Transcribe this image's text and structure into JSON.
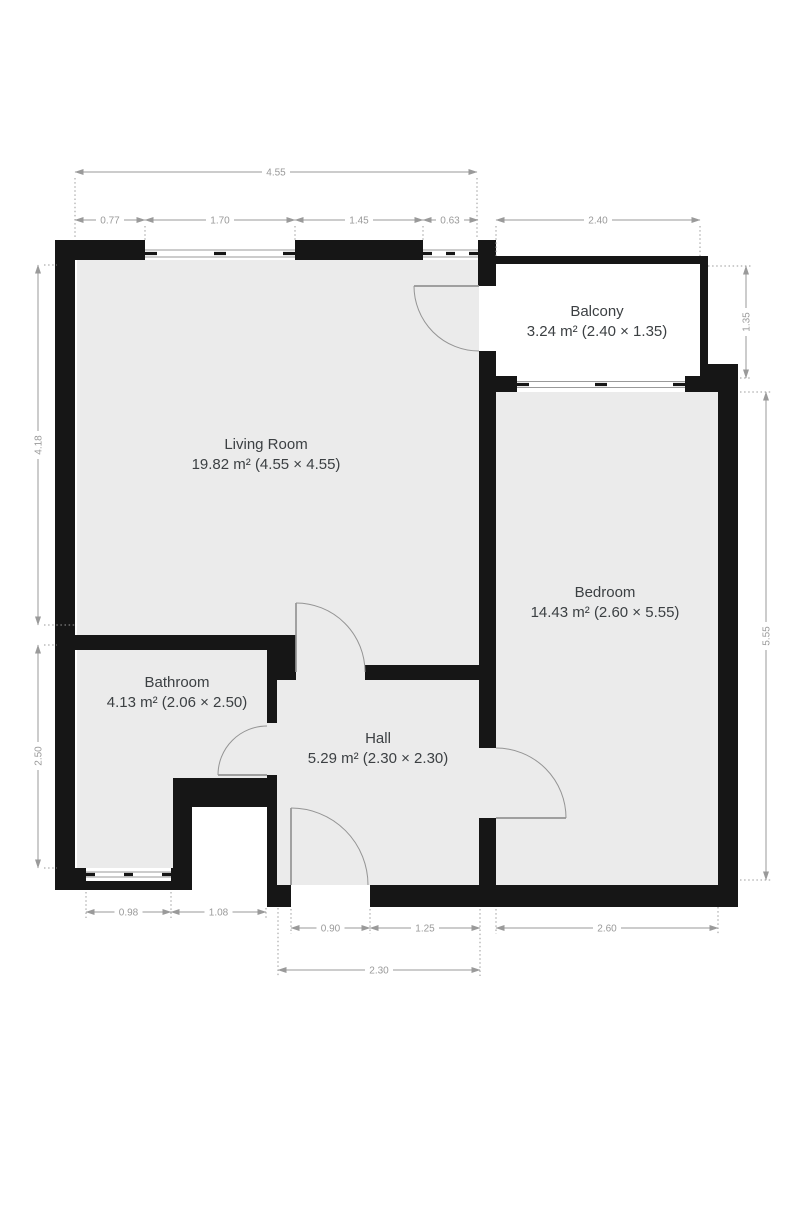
{
  "rooms": [
    {
      "name": "Living Room",
      "area": "19.82 m² (4.55 × 4.55)"
    },
    {
      "name": "Balcony",
      "area": "3.24 m² (2.40 × 1.35)"
    },
    {
      "name": "Bedroom",
      "area": "14.43 m² (2.60 × 5.55)"
    },
    {
      "name": "Bathroom",
      "area": "4.13 m² (2.06 × 2.50)"
    },
    {
      "name": "Hall",
      "area": "5.29 m² (2.30 × 2.30)"
    }
  ],
  "dims": {
    "top_total": "4.55",
    "top_seg1": "0.77",
    "top_seg2": "1.70",
    "top_seg3": "1.45",
    "top_seg4": "0.63",
    "balcony_width": "2.40",
    "left_upper": "4.18",
    "left_lower": "2.50",
    "right_balcony": "1.35",
    "right_bedroom": "5.55",
    "bottom_bath": "0.98",
    "bottom_notch": "1.08",
    "bottom_door": "0.90",
    "bottom_hall_right": "1.25",
    "bottom_bedroom": "2.60",
    "bottom_hall_total": "2.30"
  },
  "colors": {
    "wall": "#161616",
    "floor": "#ebebeb",
    "dimension": "#9a9a9a",
    "label": "#3c4043",
    "background": "#ffffff",
    "window_line": "#9a9a9a",
    "door": "#949494"
  }
}
